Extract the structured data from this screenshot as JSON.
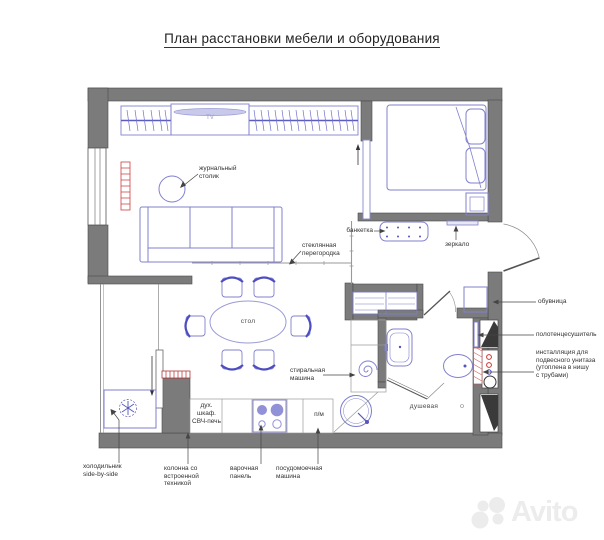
{
  "title": "План расстановки мебели и оборудования",
  "watermark": "Avito",
  "colors": {
    "wall": "#7b7b7b",
    "furniture_stroke": "#8080cf",
    "furniture_dark": "#5555bb",
    "radiator_red": "#cc4040",
    "label_text": "#333333",
    "glass_partition": "#999999",
    "watermark_gray": "#ececec"
  },
  "rooms": {
    "dining_table": "стол",
    "shower": "душевая"
  },
  "labels": {
    "coffee_table": "журнальный\nстолик",
    "glass_partition": "стеклянная\nперегородка",
    "bench": "банкетка",
    "mirror": "зеркало",
    "shoe_cabinet": "обувница",
    "towel_dryer": "полотенцесушитель",
    "toilet_installation": "инсталляция для\nподвесного унитаза\n(утоплена в нишу\nс трубами)",
    "washing_machine": "стиральная\nмашина",
    "oven_microwave": "дух.\nшкаф.\nСВЧ-печь",
    "dishwasher_short": "п/м",
    "tv": "TV",
    "fridge": "холодильник\nside-by-side",
    "appliance_column": "колонна со\nвстроенной\nтехникой",
    "hob": "варочная\nпанель",
    "dishwasher": "посудомоечная\nмашина"
  }
}
